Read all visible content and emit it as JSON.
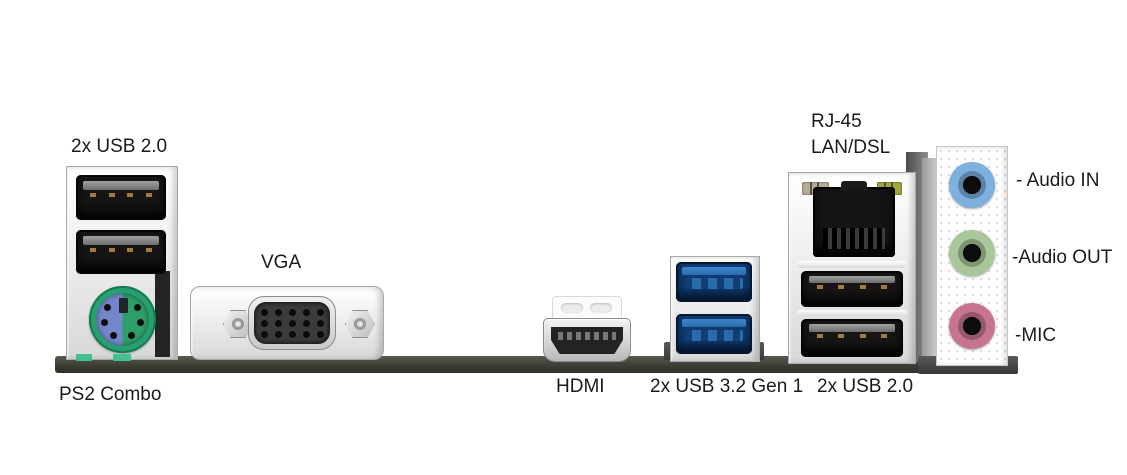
{
  "image": {
    "description": "Motherboard rear I/O port panel photo with annotation labels"
  },
  "colors": {
    "pcb": "#3c3e35",
    "usb2_port": "#171513",
    "usb3_port": "#2a6cab",
    "ps2_green": "#2f9e68",
    "ps2_purple": "#7487cb",
    "lan_led_left": "#b6ad96",
    "lan_led_right": "#a0a73f",
    "audio_in": "#7cb0de",
    "audio_out": "#a9c79b",
    "mic": "#c7758f"
  },
  "ports": {
    "usb2_left": {
      "label": "2x USB 2.0"
    },
    "ps2": {
      "label": "PS2 Combo"
    },
    "vga": {
      "label": "VGA"
    },
    "hdmi": {
      "label": "HDMI"
    },
    "usb32": {
      "label": "2x USB 3.2 Gen 1"
    },
    "rj45": {
      "label_line1": "RJ-45",
      "label_line2": "LAN/DSL"
    },
    "usb2_right": {
      "label": "2x USB 2.0"
    },
    "audio": {
      "audio_in": {
        "label": "- Audio IN"
      },
      "audio_out": {
        "label": "-Audio OUT"
      },
      "mic": {
        "label": "-MIC"
      }
    }
  }
}
